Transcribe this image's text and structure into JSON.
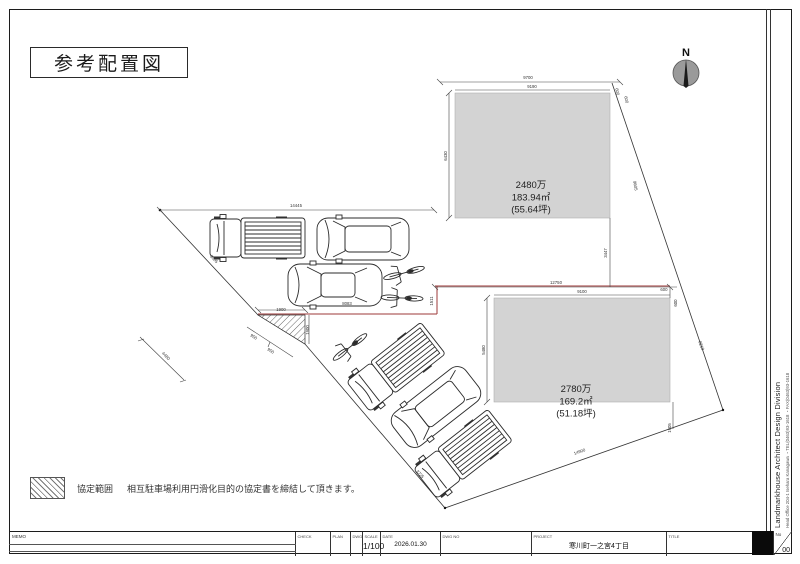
{
  "page": {
    "title": "参考配置図"
  },
  "north": {
    "label": "N"
  },
  "plots": [
    {
      "name": "plot-upper",
      "price": "2480万",
      "area": "183.94㎡",
      "tsubo": "(55.64坪)",
      "label_x": 531,
      "label_y": 188
    },
    {
      "name": "plot-lower",
      "price": "2780万",
      "area": "169.2㎡",
      "tsubo": "(51.18坪)",
      "label_x": 576,
      "label_y": 392
    }
  ],
  "dimensions": [
    {
      "text": "9700",
      "x": 528,
      "y": 79,
      "r": 0
    },
    {
      "text": "9190",
      "x": 532,
      "y": 88,
      "r": 0
    },
    {
      "text": "600",
      "x": 616,
      "y": 92,
      "r": 78
    },
    {
      "text": "600",
      "x": 625,
      "y": 100,
      "r": 78
    },
    {
      "text": "6430",
      "x": 447,
      "y": 156,
      "r": -90
    },
    {
      "text": "3447",
      "x": 607,
      "y": 253,
      "r": -90
    },
    {
      "text": "14445",
      "x": 296,
      "y": 207,
      "r": 0
    },
    {
      "text": "12750",
      "x": 556,
      "y": 284,
      "r": 0
    },
    {
      "text": "9100",
      "x": 582,
      "y": 293,
      "r": 0
    },
    {
      "text": "5480",
      "x": 485,
      "y": 350,
      "r": -90
    },
    {
      "text": "600",
      "x": 664,
      "y": 291,
      "r": 0
    },
    {
      "text": "600",
      "x": 677,
      "y": 303,
      "r": -90
    },
    {
      "text": "1905",
      "x": 671,
      "y": 428,
      "r": -90
    },
    {
      "text": "1511",
      "x": 433,
      "y": 301,
      "r": -90
    },
    {
      "text": "8083",
      "x": 347,
      "y": 305,
      "r": 0
    },
    {
      "text": "1900",
      "x": 281,
      "y": 311,
      "r": 0
    },
    {
      "text": "1900",
      "x": 309,
      "y": 330,
      "r": -90
    },
    {
      "text": "950",
      "x": 253,
      "y": 338,
      "r": 32
    },
    {
      "text": "950",
      "x": 270,
      "y": 352,
      "r": 32
    },
    {
      "text": "5805",
      "x": 213,
      "y": 260,
      "r": 46
    },
    {
      "text": "4480",
      "x": 165,
      "y": 357,
      "r": 46
    },
    {
      "text": "3725",
      "x": 419,
      "y": 475,
      "r": 48
    },
    {
      "text": "14900",
      "x": 580,
      "y": 453,
      "r": -19
    },
    {
      "text": "9605",
      "x": 634,
      "y": 186,
      "r": 80
    },
    {
      "text": "8210",
      "x": 700,
      "y": 346,
      "r": 70
    }
  ],
  "legend": {
    "label": "協定範囲",
    "text": "相互駐車場利用円滑化目的の協定書を締結して頂きます。"
  },
  "title_block": {
    "memo_label": "MEMO",
    "cells": [
      {
        "label": "CHECK",
        "value": ""
      },
      {
        "label": "PLAN",
        "value": ""
      },
      {
        "label": "DWG.",
        "value": ""
      },
      {
        "label": "SCALE",
        "value": "1/100"
      },
      {
        "label": "DATE",
        "value": "2026.01.30"
      },
      {
        "label": "DWG NO",
        "value": ""
      },
      {
        "label": "PROJECT",
        "value": "寒川町一之宮4丁目"
      },
      {
        "label": "TITLE",
        "value": ""
      }
    ],
    "sheet_no_label": "No",
    "sheet_no": "00"
  },
  "sidebar": {
    "company": "Landmarkhouse Architect Design Division",
    "address": "Head Office 204-1 Isehara Kanagawa ・TEL(0463)93-1618 ・FAX(0463)93-1618"
  },
  "site": {
    "colors": {
      "plot_fill": "#d3d3d3",
      "line": "#333333",
      "boundary_red": "#9e3a3a",
      "north_disc": "#9a9a9a"
    },
    "vehicles": [
      {
        "type": "pickup",
        "x": 258,
        "y": 238,
        "r": 0
      },
      {
        "type": "wagon",
        "x": 363,
        "y": 239,
        "r": 0
      },
      {
        "type": "sedan",
        "x": 335,
        "y": 285,
        "r": 0
      },
      {
        "type": "bike",
        "x": 404,
        "y": 273,
        "r": -15
      },
      {
        "type": "bike",
        "x": 402,
        "y": 298,
        "r": 2
      },
      {
        "type": "bike",
        "x": 350,
        "y": 347,
        "r": -38
      },
      {
        "type": "pickup",
        "x": 396,
        "y": 367,
        "r": -38
      },
      {
        "type": "wagon",
        "x": 436,
        "y": 407,
        "r": -38
      },
      {
        "type": "pickup",
        "x": 463,
        "y": 454,
        "r": -38
      }
    ]
  }
}
